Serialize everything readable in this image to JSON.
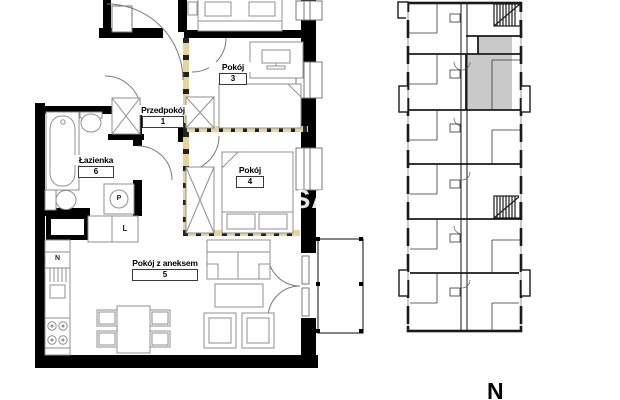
{
  "plan": {
    "rooms": [
      {
        "name": "Przedpokój",
        "number": "1"
      },
      {
        "name": "Pokój",
        "number": "3"
      },
      {
        "name": "Pokój",
        "number": "4"
      },
      {
        "name": "Pokój z aneksem",
        "number": "5"
      },
      {
        "name": "Łazienka",
        "number": "6"
      }
    ],
    "appliance_labels": {
      "washing_machine": "P",
      "fridge": "L",
      "kitchen_cabinet": "N"
    }
  },
  "building_overview": {
    "highlight_color": "#c9c9c9"
  },
  "compass": {
    "north": "N"
  },
  "watermark": {
    "text": "SA"
  },
  "colors": {
    "walls": "#000000",
    "furniture_lines": "#8f8f8f",
    "optional_partition": "#e7d49a",
    "partition_dashes": "#222222",
    "unit_highlight": "#c9c9c9",
    "background": "#ffffff"
  }
}
